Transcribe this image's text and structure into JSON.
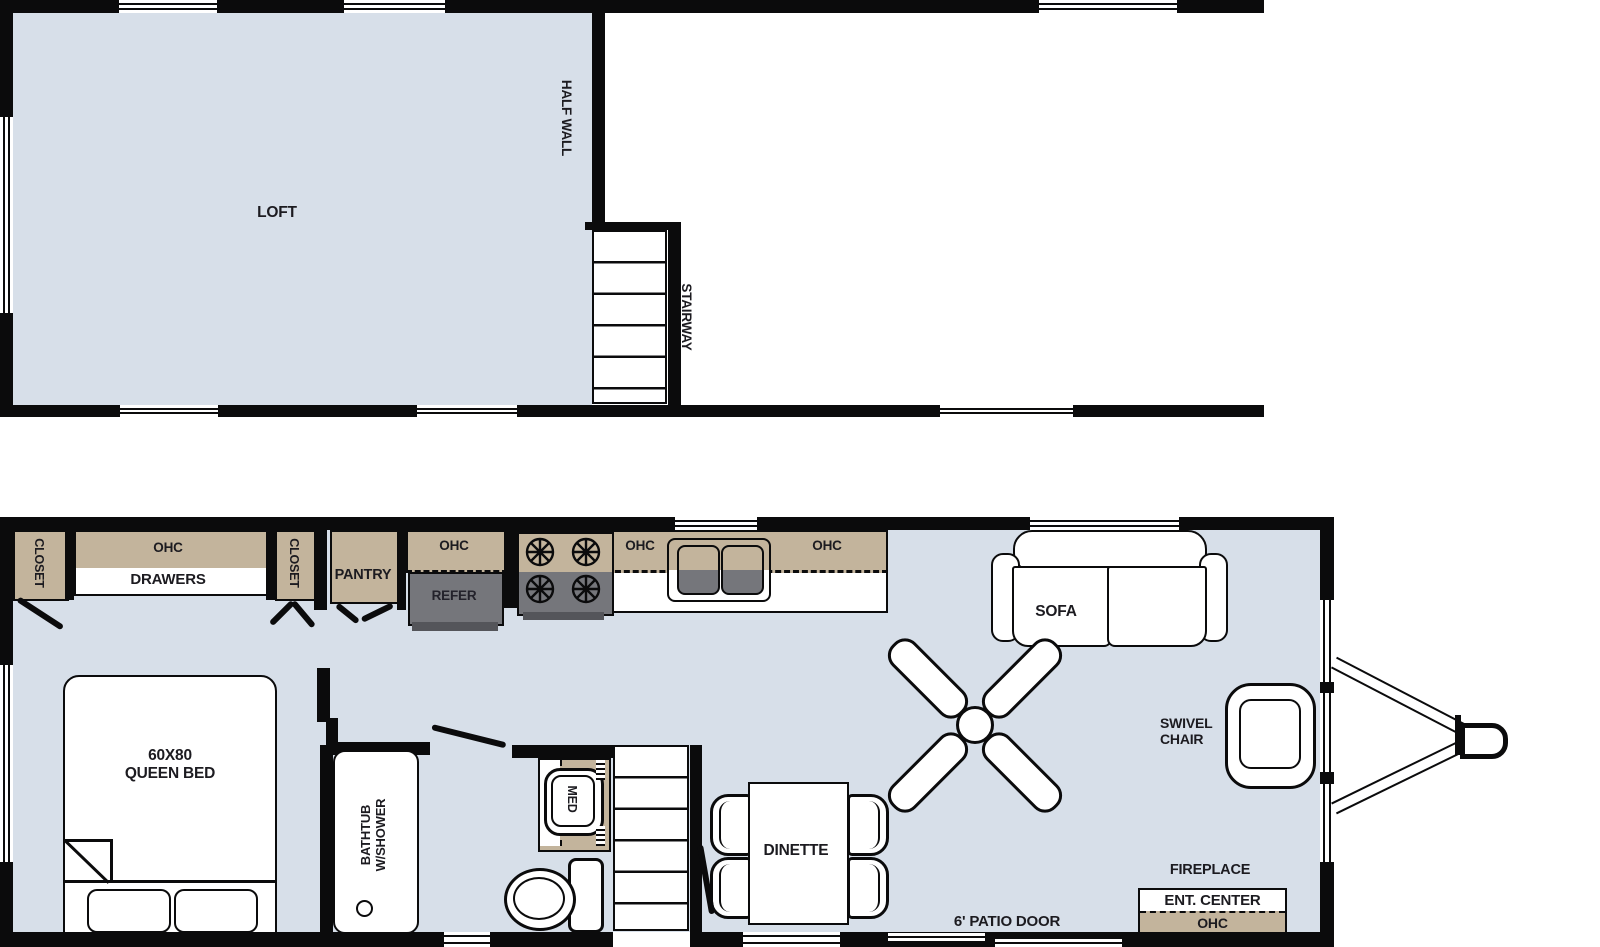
{
  "colors": {
    "wall": "#0b0b0c",
    "floor": "#d7dfe9",
    "cabinet_tan": "#c3b49c",
    "appliance_gray": "#75767b",
    "background": "#ffffff"
  },
  "upper_plan": {
    "loft_label": "LOFT",
    "half_wall_label": "HALF WALL",
    "stairway_label": "STAIRWAY"
  },
  "main_plan": {
    "bedroom": {
      "closet_left": "CLOSET",
      "ohc": "OHC",
      "drawers": "DRAWERS",
      "closet_right": "CLOSET",
      "bed_size": "60X80",
      "bed_type": "QUEEN BED"
    },
    "kitchen": {
      "pantry": "PANTRY",
      "ohc_refer": "OHC",
      "refer": "REFER",
      "ohc_1": "OHC",
      "ohc_2": "OHC"
    },
    "bath": {
      "tub_line1": "BATHTUB",
      "tub_line2": "W/SHOWER",
      "med": "MED"
    },
    "living": {
      "dinette": "DINETTE",
      "sofa": "SOFA",
      "swivel_line1": "SWIVEL",
      "swivel_line2": "CHAIR",
      "fireplace": "FIREPLACE",
      "ent_center": "ENT. CENTER",
      "ohc_ent": "OHC",
      "patio_door": "6' PATIO DOOR"
    }
  }
}
